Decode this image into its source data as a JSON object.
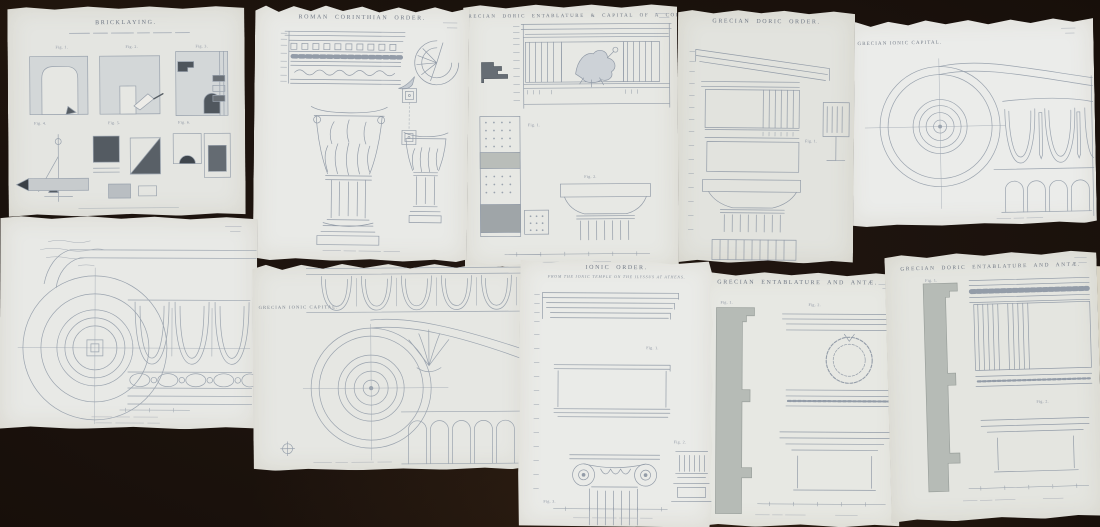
{
  "scene": {
    "description": "Ten antique architectural engraving plates (classical orders) laid out on a dark surface",
    "surface_color": "#170f0a",
    "paper_color": "#e8e9e5",
    "ink_color": "#929ba7"
  },
  "sheets": [
    {
      "key": "bricklaying",
      "title": "BRICKLAYING.",
      "figs": [
        "Fig. 1.",
        "Fig. 2.",
        "Fig. 3.",
        "Fig. 4.",
        "Fig. 5.",
        "Fig. 6."
      ]
    },
    {
      "key": "roman-corinthian-order",
      "title": "ROMAN CORINTHIAN ORDER."
    },
    {
      "key": "grecian-doric-entablature-capital",
      "title": "GRECIAN DORIC ENTABLATURE & CAPITAL OF A COLUMN.",
      "figs": [
        "Fig. 1.",
        "Fig. 2."
      ]
    },
    {
      "key": "grecian-doric-order",
      "title": "GRECIAN DORIC ORDER.",
      "figs": [
        "Fig. 1."
      ]
    },
    {
      "key": "grecian-ionic-capital-top",
      "title": "GRECIAN IONIC CAPITAL."
    },
    {
      "key": "ionic-volute-study",
      "title": ""
    },
    {
      "key": "grecian-ionic-capital-bottom",
      "title": "GRECIAN IONIC CAPITAL."
    },
    {
      "key": "ionic-order",
      "title": "IONIC ORDER.",
      "subtitle": "FROM THE IONIC TEMPLE ON THE ILYSSUS AT ATHENS.",
      "figs": [
        "Fig. 1.",
        "Fig. 2.",
        "Fig. 3."
      ]
    },
    {
      "key": "grecian-entablature-anta",
      "title": "GRECIAN ENTABLATURE AND ANTÆ.",
      "figs": [
        "Fig. 1.",
        "Fig. 2."
      ]
    },
    {
      "key": "grecian-doric-entablature-anta",
      "title": "GRECIAN DORIC ENTABLATURE AND ANTÆ.",
      "figs": [
        "Fig. 1.",
        "Fig. 2."
      ]
    }
  ]
}
